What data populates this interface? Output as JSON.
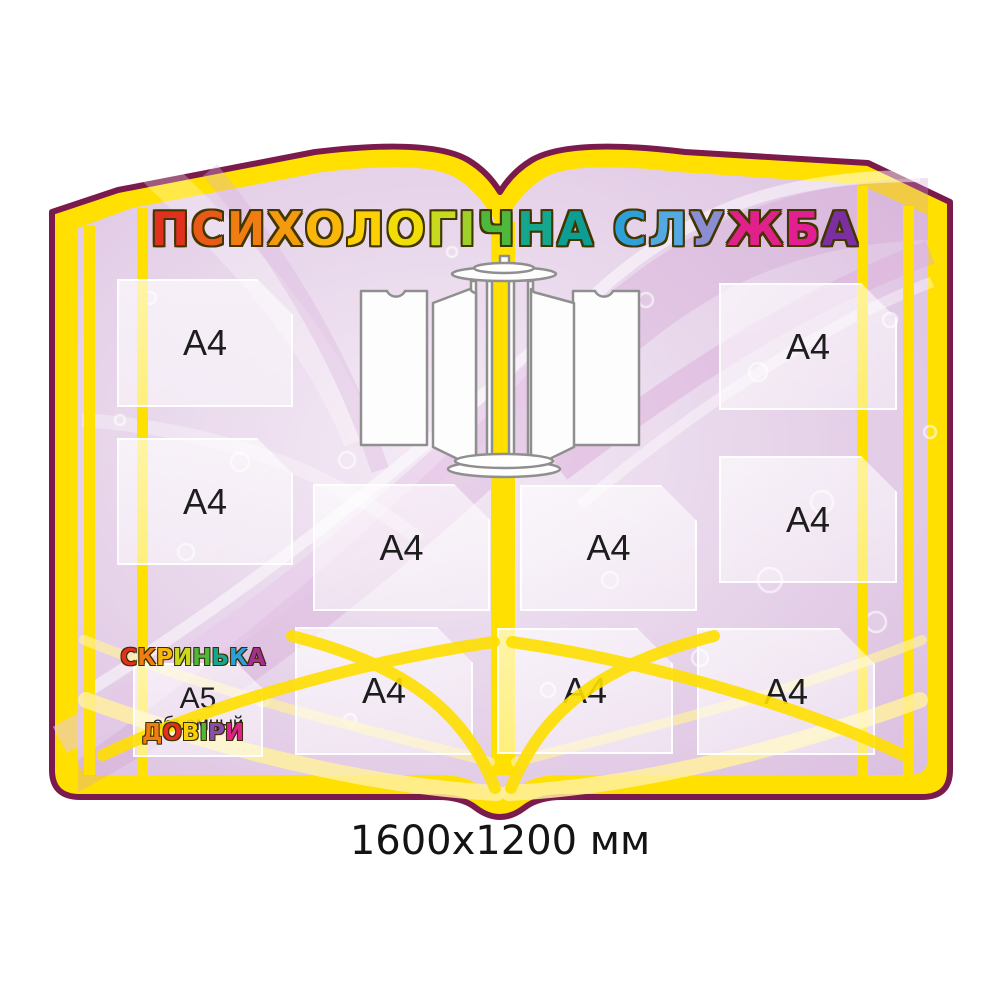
{
  "board": {
    "title": {
      "text": "ПСИХОЛОГІЧНА СЛУЖБА",
      "letters": [
        {
          "ch": "П",
          "color": "#e0301e"
        },
        {
          "ch": "С",
          "color": "#ea5a17"
        },
        {
          "ch": "И",
          "color": "#f07d12"
        },
        {
          "ch": "Х",
          "color": "#f49a0e"
        },
        {
          "ch": "О",
          "color": "#fab70b"
        },
        {
          "ch": "Л",
          "color": "#fcd005"
        },
        {
          "ch": "О",
          "color": "#f2de07"
        },
        {
          "ch": "Г",
          "color": "#c8da1e"
        },
        {
          "ch": "І",
          "color": "#9ed02c"
        },
        {
          "ch": "Ч",
          "color": "#4eb83c"
        },
        {
          "ch": "Н",
          "color": "#14a78d"
        },
        {
          "ch": "А",
          "color": "#0c9e93"
        },
        {
          "ch": " "
        },
        {
          "ch": "С",
          "color": "#2d9fd9"
        },
        {
          "ch": "Л",
          "color": "#55a9e2"
        },
        {
          "ch": "У",
          "color": "#8b8ed3"
        },
        {
          "ch": "Ж",
          "color": "#e0218a"
        },
        {
          "ch": "Б",
          "color": "#e31e93"
        },
        {
          "ch": "А",
          "color": "#7c2fa0"
        }
      ]
    },
    "trust_box": {
      "text": "Скринька Довіри",
      "line1": [
        {
          "ch": "С",
          "color": "#e0301e"
        },
        {
          "ch": "К",
          "color": "#f07d12"
        },
        {
          "ch": "Р",
          "color": "#fab70b"
        },
        {
          "ch": "И",
          "color": "#c8da1e"
        },
        {
          "ch": "Н",
          "color": "#4eb83c"
        },
        {
          "ch": "Ь",
          "color": "#14a78d"
        },
        {
          "ch": "К",
          "color": "#2d9fd9"
        },
        {
          "ch": "А",
          "color": "#a62d93"
        }
      ],
      "line2": [
        {
          "ch": "Д",
          "color": "#f07d12"
        },
        {
          "ch": "О",
          "color": "#e0301e"
        },
        {
          "ch": "В",
          "color": "#fcd005"
        },
        {
          "ch": "І",
          "color": "#4eb83c"
        },
        {
          "ch": "Р",
          "color": "#8b4bb1"
        },
        {
          "ch": "И",
          "color": "#e0218a"
        }
      ]
    },
    "pockets": [
      {
        "id": "left-top",
        "label": "A4"
      },
      {
        "id": "left-middle",
        "label": "A4"
      },
      {
        "id": "center-row-left",
        "label": "A4"
      },
      {
        "id": "center-row-right",
        "label": "A4"
      },
      {
        "id": "right-top",
        "label": "A4"
      },
      {
        "id": "right-middle",
        "label": "A4"
      },
      {
        "id": "bottom-left",
        "label": "A4"
      },
      {
        "id": "bottom-center",
        "label": "A4"
      },
      {
        "id": "bottom-right",
        "label": "A4"
      },
      {
        "id": "a5-volume",
        "label": "A5",
        "sublabel": "объемный"
      }
    ],
    "dimensions_caption": "1600x1200 мм",
    "colors": {
      "outline": "#7b1a4d",
      "band": "#ffe000",
      "pale_arc": "#fff0a0",
      "interior": "#e6d3e8",
      "pocket_fill": "rgba(255,255,255,0.55)",
      "caption_text": "#141414"
    }
  }
}
